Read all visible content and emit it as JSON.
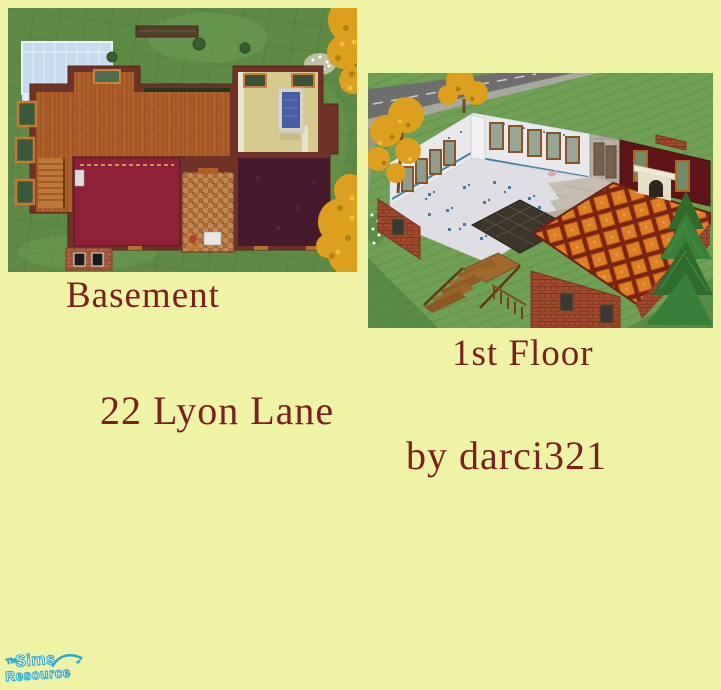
{
  "page": {
    "background_color": "#EFF3A5"
  },
  "captions": {
    "color": "#7C1F1F",
    "basement": "Basement",
    "first_floor": "1st Floor",
    "address": "22 Lyon Lane",
    "credit": "by darci321"
  },
  "logo": {
    "the": "The",
    "sims": "Sims",
    "resource": "Resource",
    "text_color": "#FFFFFF",
    "outline_color": "#2FA8CC"
  }
}
